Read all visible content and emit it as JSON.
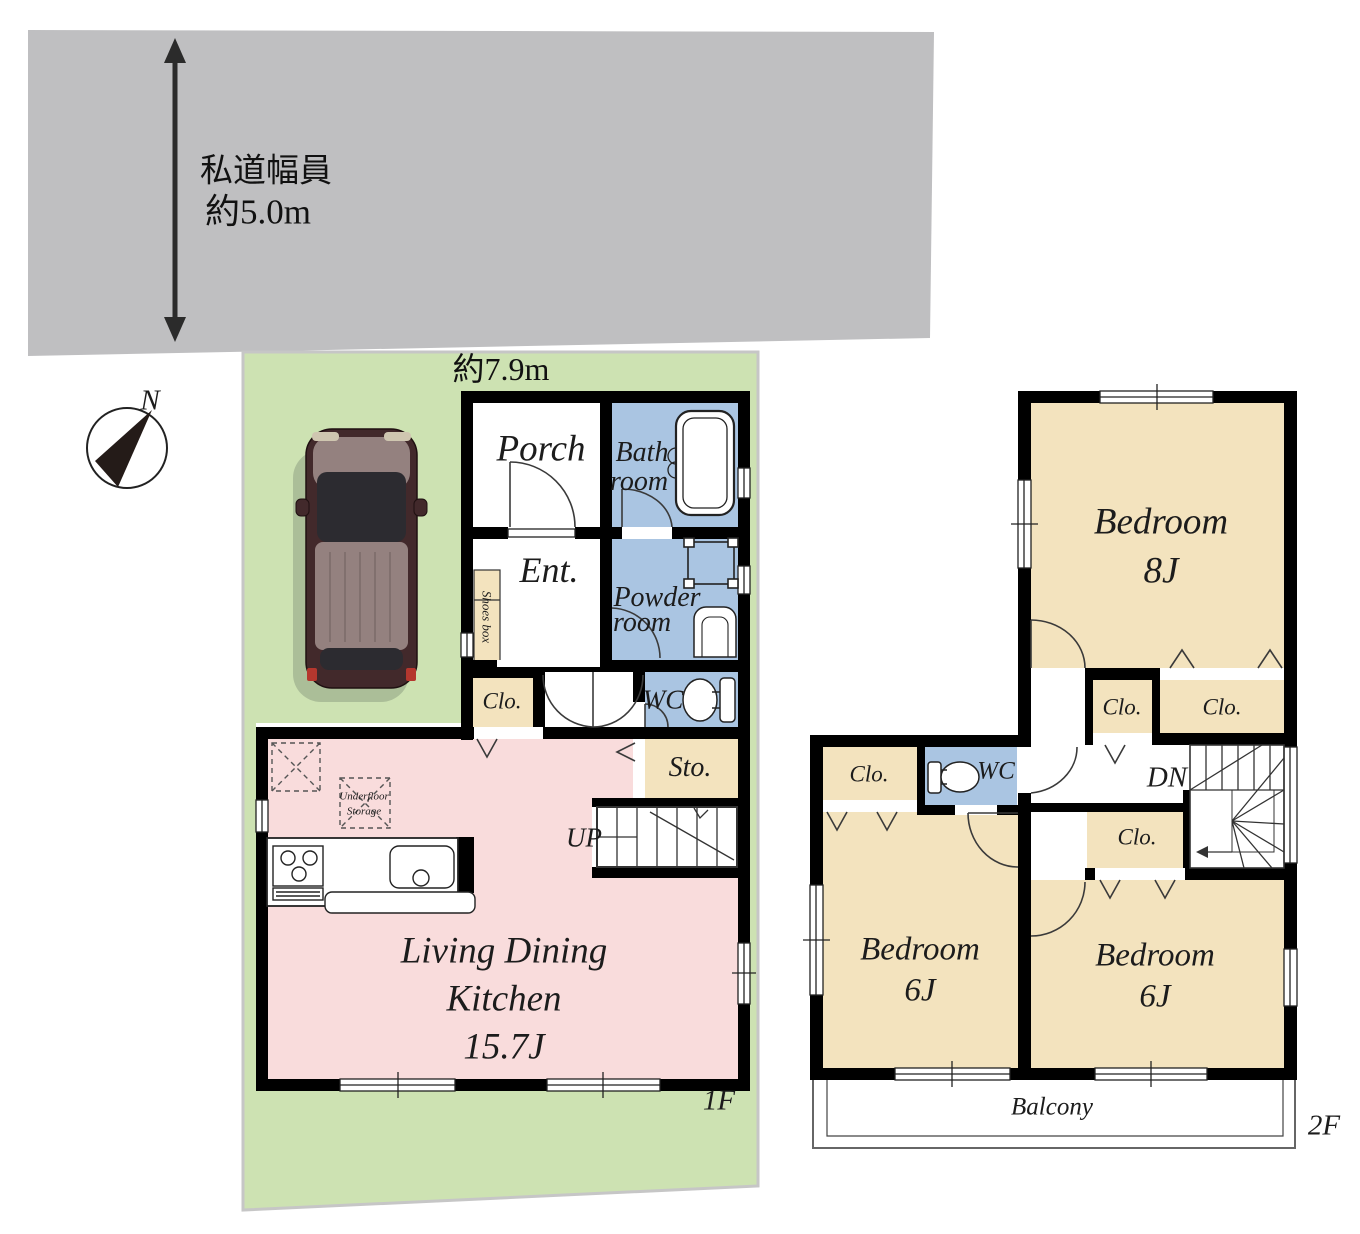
{
  "colors": {
    "road": "#bfbfc1",
    "lot": "#cde2b2",
    "ldk_pink": "#f9dcdc",
    "room_tan": "#f3e3be",
    "room_blue": "#aac5e2",
    "wall": "#000000",
    "line": "#333333",
    "car_body": "#42292b",
    "car_roof": "#94817f"
  },
  "site": {
    "road_width_line1": "私道幅員",
    "road_width_line2": "約5.0m",
    "frontage": "約7.9m",
    "compass_north": "N"
  },
  "floor1": {
    "label": "1F",
    "porch": "Porch",
    "bath_line1": "Bath",
    "bath_line2": "room",
    "entrance": "Ent.",
    "shoes_box": "Shoes box",
    "powder_line1": "Powder",
    "powder_line2": "room",
    "wc": "WC",
    "closet": "Clo.",
    "storage": "Sto.",
    "stairs": "UP",
    "underfloor_line1": "Underfloor",
    "underfloor_line2": "Storage",
    "ldk_line1": "Living Dining",
    "ldk_line2": "Kitchen",
    "ldk_size": "15.7J"
  },
  "floor2": {
    "label": "2F",
    "bedroom_main": "Bedroom",
    "bedroom_main_size": "8J",
    "closet_hall_left": "Clo.",
    "closet_hall_right": "Clo.",
    "closet_west": "Clo.",
    "closet_mid": "Clo.",
    "wc": "WC",
    "stairs": "DN",
    "bedroom_west": "Bedroom",
    "bedroom_west_size": "6J",
    "bedroom_south": "Bedroom",
    "bedroom_south_size": "6J",
    "balcony": "Balcony"
  }
}
